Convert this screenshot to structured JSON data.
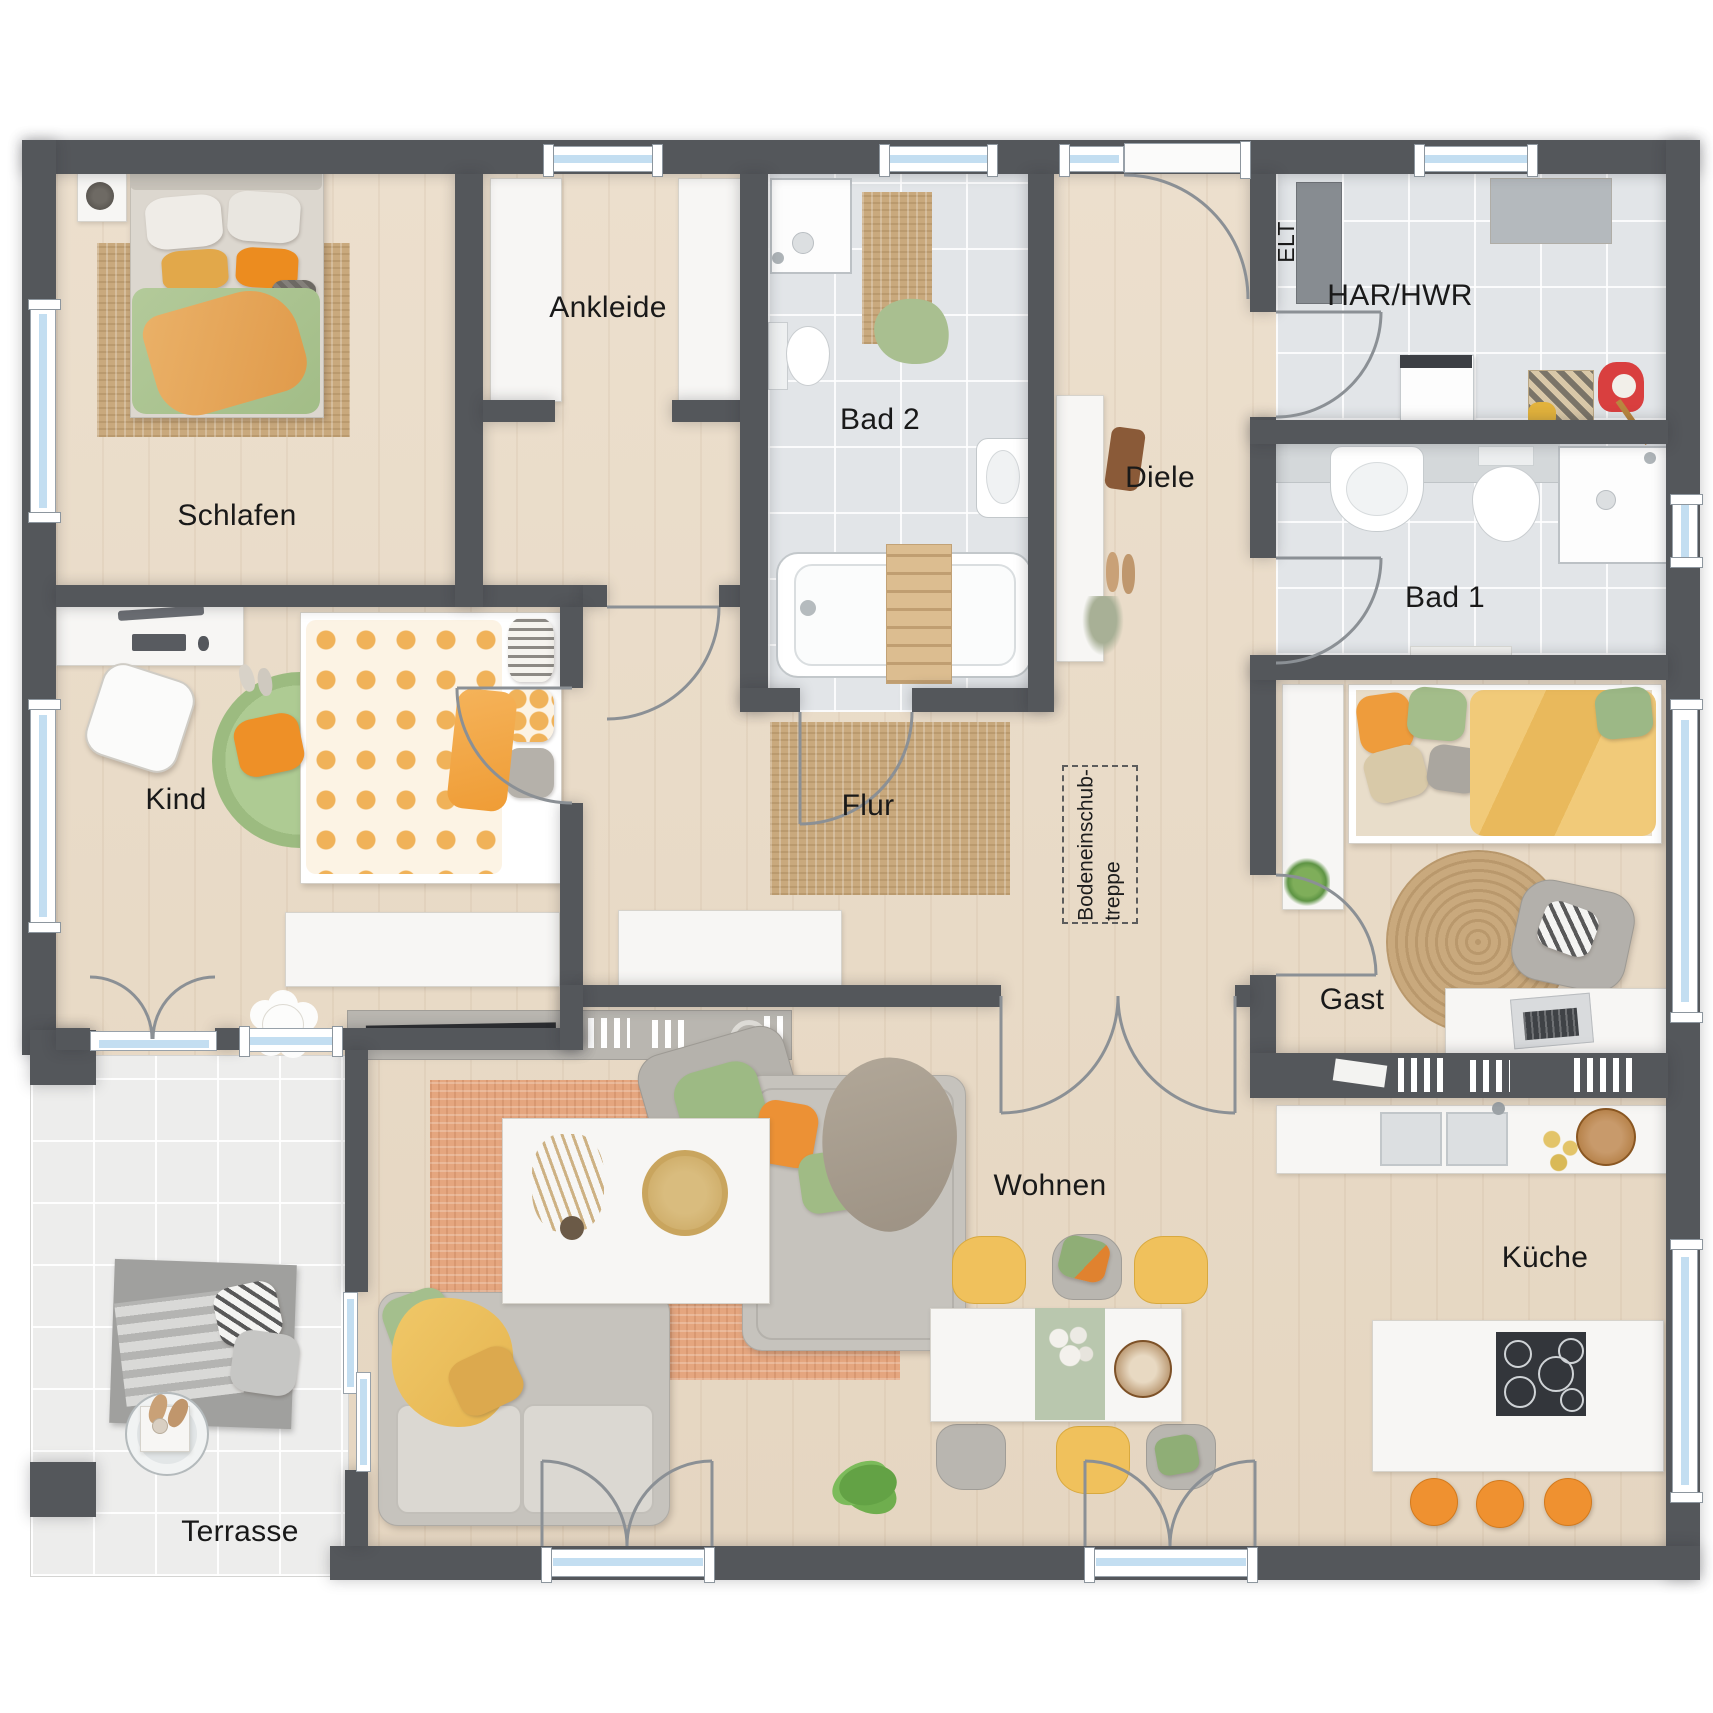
{
  "plan_title": "Bungalow Grundriss Erdgeschoss",
  "rooms": [
    {
      "id": "schlafen",
      "label": "Schlafen"
    },
    {
      "id": "ankleide",
      "label": "Ankleide"
    },
    {
      "id": "bad2",
      "label": "Bad 2"
    },
    {
      "id": "diele",
      "label": "Diele"
    },
    {
      "id": "har_hwr",
      "label": "HAR/HWR"
    },
    {
      "id": "bad1",
      "label": "Bad 1"
    },
    {
      "id": "kind",
      "label": "Kind"
    },
    {
      "id": "flur",
      "label": "Flur"
    },
    {
      "id": "gast",
      "label": "Gast"
    },
    {
      "id": "wohnen",
      "label": "Wohnen"
    },
    {
      "id": "kueche",
      "label": "Küche"
    },
    {
      "id": "terrasse",
      "label": "Terrasse"
    }
  ],
  "annotations": {
    "elt": "ELT",
    "attic_ladder_line1": "Bodeneinschub-",
    "attic_ladder_line2": "treppe"
  },
  "palette": {
    "wall": "#54575b",
    "wood_floor": "#e9dcc9",
    "tile_floor": "#e2e5e8",
    "terrace_tile": "#ededec",
    "window_glass": "#c3def1",
    "accent_orange": "#ec9135",
    "accent_green": "#a3bf8c",
    "accent_yellow": "#eec263",
    "rug_jute": "#c9a97d",
    "rug_terracotta": "#e5a67f",
    "label_color": "#191919"
  }
}
